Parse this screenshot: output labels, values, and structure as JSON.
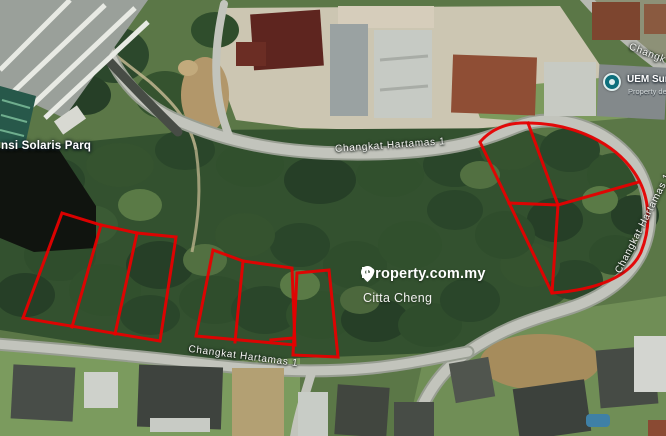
{
  "map": {
    "road_labels": [
      {
        "id": "top",
        "text": "Changkat Hartamas 1"
      },
      {
        "id": "bottom",
        "text": "Changkat Hartamas 1"
      },
      {
        "id": "right",
        "text": "Changkat Hartamas 1"
      },
      {
        "id": "corner",
        "text": "Changk"
      }
    ],
    "place_labels": [
      {
        "id": "solaris",
        "text": "nsi Solaris Parq"
      }
    ],
    "poi": {
      "title": "UEM Sun",
      "subtitle": "Property de",
      "icon": "place-dot-icon",
      "icon_color": "#0d6f7c"
    }
  },
  "watermark": {
    "icon": "location-pin-icon",
    "brand": "iProperty.com.my",
    "agent": "Citta Cheng"
  },
  "annotations": {
    "color": "#e60000",
    "shapes": [
      {
        "id": "left-outline",
        "closed": true,
        "points": "62,213 101,225 137,233 176,237 160,341 23,318"
      },
      {
        "id": "left-divider-1",
        "closed": false,
        "points": "101,225 72,327"
      },
      {
        "id": "left-divider-2",
        "closed": false,
        "points": "137,233 115,334"
      },
      {
        "id": "mid-outline",
        "closed": true,
        "points": "213,250 243,261 292,268 295,345 196,336"
      },
      {
        "id": "mid-divider",
        "closed": false,
        "points": "243,261 235,342"
      },
      {
        "id": "mid-narrow-lot",
        "closed": true,
        "points": "297,273 329,270 338,357 293,355"
      },
      {
        "id": "mid-stub",
        "closed": false,
        "points": "293,338 271,340"
      },
      {
        "id": "right-outline",
        "d": "M 480,142 C 494,126 512,122 530,123 C 575,124 614,143 634,172 C 650,195 652,225 641,252 C 630,277 596,290 552,293 Z"
      },
      {
        "id": "right-divider-vertical",
        "closed": false,
        "points": "528,123 558,205 552,293"
      },
      {
        "id": "right-divider-horizontal",
        "closed": false,
        "points": "509,203 558,205 639,182"
      }
    ]
  }
}
